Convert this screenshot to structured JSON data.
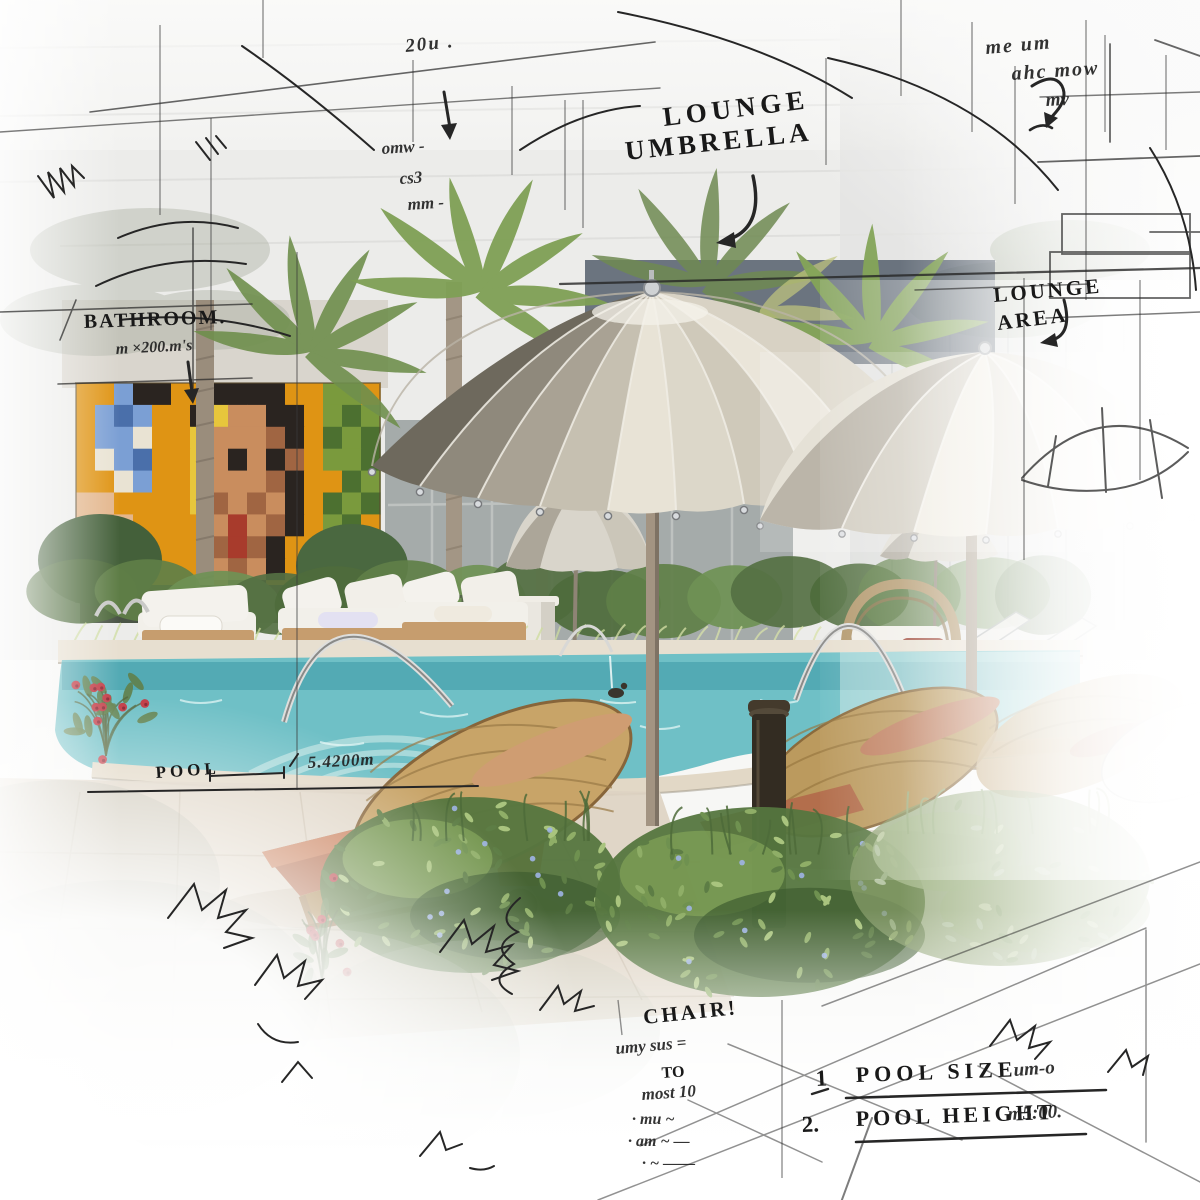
{
  "annotations": {
    "top_right_scribble": {
      "line1": "me um",
      "line2": "ahc mow",
      "line3": "mv"
    },
    "top_center": {
      "label": "20u ."
    },
    "left_notes": {
      "line1": "omw -",
      "line2": "cs3",
      "line3": "mm -"
    },
    "lounge_umbrella": {
      "line1": "LOUNGE",
      "line2": "UMBRELLA"
    },
    "lounge_area": {
      "line1": "LOUNGE",
      "line2": "AREA"
    },
    "bathroom": {
      "line1": "BATHROOM.",
      "line2": "m ×200.m's"
    },
    "pool_dimension": {
      "label": "POOL",
      "value": "5.4200m"
    },
    "chair_note": {
      "line1": "CHAIR!",
      "line2": "umy sus =",
      "line3": "TO",
      "line4": "most 10",
      "line5": "· mu ~",
      "line6": "· am ~ —",
      "line7": "· ~ ——"
    },
    "spec_list": {
      "items": [
        {
          "num": "1",
          "label": "POOL SIZE",
          "value": "um-o"
        },
        {
          "num": "2.",
          "label": "POOL HEIGHT",
          "value": "m5:00."
        }
      ]
    }
  },
  "colors": {
    "pool_water": "#5fbac2",
    "pool_shallow": "#bfe6e4",
    "mural_orange": "#df9414",
    "umbrella_light": "#e8e3d6",
    "umbrella_shade": "#6e695d",
    "umbrella_pole": "#a39482",
    "wicker": "#c8a468",
    "cushion_terracotta": "#b26b4b",
    "foliage": "#5d7d45",
    "deck": "#ddd3c2",
    "daybed_white": "#f3f1ec",
    "ink": "#1c1c1c"
  },
  "mural": {
    "palette": {
      "O": "#df9414",
      "Y": "#e7c63c",
      "D": "#2a2420",
      "S": "#c98d5e",
      "T": "#a06542",
      "W": "#e9e3d3",
      "B": "#7b9fd4",
      "b": "#4a6faa",
      "G": "#7a9a3d",
      "g": "#4c7030",
      "R": "#a83b2c",
      "P": "#e3b68c"
    },
    "rows": [
      "OOBDDOODDDDOOGGO",
      "OBbBOODYSSDDOGgG",
      "OBBWOOYSSSTDOgGg",
      "OWBbOOYSDSDTOGGg",
      "OOWBOOYSSSTDOOgG",
      "PPOOOOYTSTSDOgGg",
      "PSPOOOOSRSTDOGgO",
      "OPSPOOOTRTDOOgGg",
      "OOPSOOOSTSDOOOgO",
      "OOOOOODTDDOOOOgO"
    ]
  }
}
